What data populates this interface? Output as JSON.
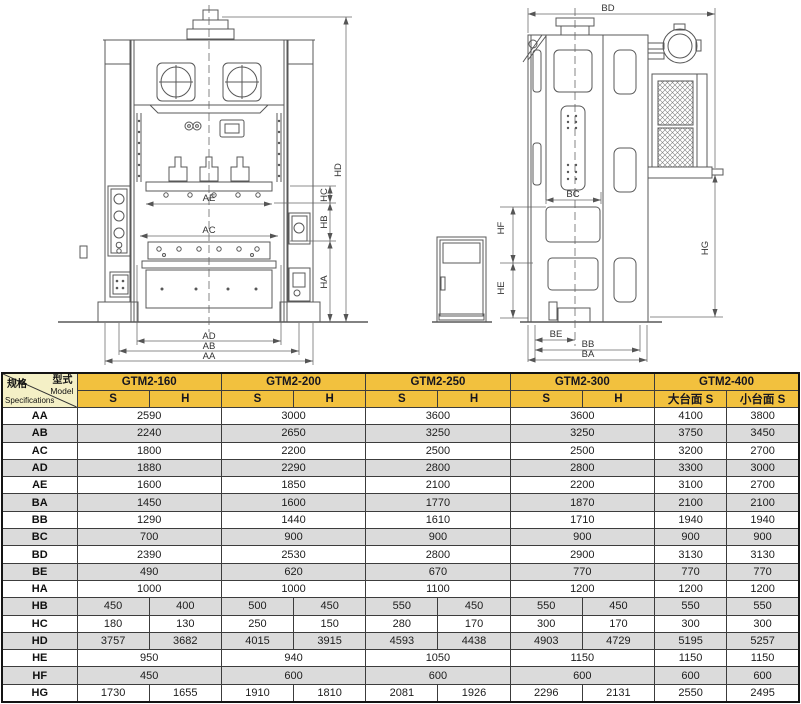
{
  "colors": {
    "header_gold": "#F2C13E",
    "corner_yellow": "#F4F0C6",
    "row_alt_gray": "#DBDBDB",
    "drawing_line": "#585858"
  },
  "drawings": {
    "front_labels": {
      "AA": "AA",
      "AB": "AB",
      "AC": "AC",
      "AD": "AD",
      "AE": "AE",
      "HA": "HA",
      "HB": "HB",
      "HC": "HC",
      "HD": "HD"
    },
    "side_labels": {
      "BA": "BA",
      "BB": "BB",
      "BC": "BC",
      "BD": "BD",
      "BE": "BE",
      "HE": "HE",
      "HF": "HF",
      "HG": "HG"
    }
  },
  "table": {
    "corner": {
      "model_zh": "型式",
      "model_en": "Model",
      "spec_zh": "规格",
      "spec_en": "Specifications"
    },
    "model_groups": [
      {
        "label": "GTM2-160",
        "sub": [
          "S",
          "H"
        ]
      },
      {
        "label": "GTM2-200",
        "sub": [
          "S",
          "H"
        ]
      },
      {
        "label": "GTM2-250",
        "sub": [
          "S",
          "H"
        ]
      },
      {
        "label": "GTM2-300",
        "sub": [
          "S",
          "H"
        ]
      },
      {
        "label": "GTM2-400",
        "sub": [
          "大台面 S",
          "小台面 S"
        ]
      }
    ],
    "rows": [
      {
        "label": "AA",
        "cells": [
          {
            "v": "2590",
            "span": 2
          },
          {
            "v": "3000",
            "span": 2
          },
          {
            "v": "3600",
            "span": 2
          },
          {
            "v": "3600",
            "span": 2
          },
          {
            "v": "4100",
            "span": 1
          },
          {
            "v": "3800",
            "span": 1
          }
        ]
      },
      {
        "label": "AB",
        "cells": [
          {
            "v": "2240",
            "span": 2
          },
          {
            "v": "2650",
            "span": 2
          },
          {
            "v": "3250",
            "span": 2
          },
          {
            "v": "3250",
            "span": 2
          },
          {
            "v": "3750",
            "span": 1
          },
          {
            "v": "3450",
            "span": 1
          }
        ]
      },
      {
        "label": "AC",
        "cells": [
          {
            "v": "1800",
            "span": 2
          },
          {
            "v": "2200",
            "span": 2
          },
          {
            "v": "2500",
            "span": 2
          },
          {
            "v": "2500",
            "span": 2
          },
          {
            "v": "3200",
            "span": 1
          },
          {
            "v": "2700",
            "span": 1
          }
        ]
      },
      {
        "label": "AD",
        "cells": [
          {
            "v": "1880",
            "span": 2
          },
          {
            "v": "2290",
            "span": 2
          },
          {
            "v": "2800",
            "span": 2
          },
          {
            "v": "2800",
            "span": 2
          },
          {
            "v": "3300",
            "span": 1
          },
          {
            "v": "3000",
            "span": 1
          }
        ]
      },
      {
        "label": "AE",
        "cells": [
          {
            "v": "1600",
            "span": 2
          },
          {
            "v": "1850",
            "span": 2
          },
          {
            "v": "2100",
            "span": 2
          },
          {
            "v": "2200",
            "span": 2
          },
          {
            "v": "3100",
            "span": 1
          },
          {
            "v": "2700",
            "span": 1
          }
        ]
      },
      {
        "label": "BA",
        "cells": [
          {
            "v": "1450",
            "span": 2
          },
          {
            "v": "1600",
            "span": 2
          },
          {
            "v": "1770",
            "span": 2
          },
          {
            "v": "1870",
            "span": 2
          },
          {
            "v": "2100",
            "span": 1
          },
          {
            "v": "2100",
            "span": 1
          }
        ]
      },
      {
        "label": "BB",
        "cells": [
          {
            "v": "1290",
            "span": 2
          },
          {
            "v": "1440",
            "span": 2
          },
          {
            "v": "1610",
            "span": 2
          },
          {
            "v": "1710",
            "span": 2
          },
          {
            "v": "1940",
            "span": 1
          },
          {
            "v": "1940",
            "span": 1
          }
        ]
      },
      {
        "label": "BC",
        "cells": [
          {
            "v": "700",
            "span": 2
          },
          {
            "v": "900",
            "span": 2
          },
          {
            "v": "900",
            "span": 2
          },
          {
            "v": "900",
            "span": 2
          },
          {
            "v": "900",
            "span": 1
          },
          {
            "v": "900",
            "span": 1
          }
        ]
      },
      {
        "label": "BD",
        "cells": [
          {
            "v": "2390",
            "span": 2
          },
          {
            "v": "2530",
            "span": 2
          },
          {
            "v": "2800",
            "span": 2
          },
          {
            "v": "2900",
            "span": 2
          },
          {
            "v": "3130",
            "span": 1
          },
          {
            "v": "3130",
            "span": 1
          }
        ]
      },
      {
        "label": "BE",
        "cells": [
          {
            "v": "490",
            "span": 2
          },
          {
            "v": "620",
            "span": 2
          },
          {
            "v": "670",
            "span": 2
          },
          {
            "v": "770",
            "span": 2
          },
          {
            "v": "770",
            "span": 1
          },
          {
            "v": "770",
            "span": 1
          }
        ]
      },
      {
        "label": "HA",
        "cells": [
          {
            "v": "1000",
            "span": 2
          },
          {
            "v": "1000",
            "span": 2
          },
          {
            "v": "1100",
            "span": 2
          },
          {
            "v": "1200",
            "span": 2
          },
          {
            "v": "1200",
            "span": 1
          },
          {
            "v": "1200",
            "span": 1
          }
        ]
      },
      {
        "label": "HB",
        "cells": [
          {
            "v": "450",
            "span": 1
          },
          {
            "v": "400",
            "span": 1
          },
          {
            "v": "500",
            "span": 1
          },
          {
            "v": "450",
            "span": 1
          },
          {
            "v": "550",
            "span": 1
          },
          {
            "v": "450",
            "span": 1
          },
          {
            "v": "550",
            "span": 1
          },
          {
            "v": "450",
            "span": 1
          },
          {
            "v": "550",
            "span": 1
          },
          {
            "v": "550",
            "span": 1
          }
        ]
      },
      {
        "label": "HC",
        "cells": [
          {
            "v": "180",
            "span": 1
          },
          {
            "v": "130",
            "span": 1
          },
          {
            "v": "250",
            "span": 1
          },
          {
            "v": "150",
            "span": 1
          },
          {
            "v": "280",
            "span": 1
          },
          {
            "v": "170",
            "span": 1
          },
          {
            "v": "300",
            "span": 1
          },
          {
            "v": "170",
            "span": 1
          },
          {
            "v": "300",
            "span": 1
          },
          {
            "v": "300",
            "span": 1
          }
        ]
      },
      {
        "label": "HD",
        "cells": [
          {
            "v": "3757",
            "span": 1
          },
          {
            "v": "3682",
            "span": 1
          },
          {
            "v": "4015",
            "span": 1
          },
          {
            "v": "3915",
            "span": 1
          },
          {
            "v": "4593",
            "span": 1
          },
          {
            "v": "4438",
            "span": 1
          },
          {
            "v": "4903",
            "span": 1
          },
          {
            "v": "4729",
            "span": 1
          },
          {
            "v": "5195",
            "span": 1
          },
          {
            "v": "5257",
            "span": 1
          }
        ]
      },
      {
        "label": "HE",
        "cells": [
          {
            "v": "950",
            "span": 2
          },
          {
            "v": "940",
            "span": 2
          },
          {
            "v": "1050",
            "span": 2
          },
          {
            "v": "1150",
            "span": 2
          },
          {
            "v": "1150",
            "span": 1
          },
          {
            "v": "1150",
            "span": 1
          }
        ]
      },
      {
        "label": "HF",
        "cells": [
          {
            "v": "450",
            "span": 2
          },
          {
            "v": "600",
            "span": 2
          },
          {
            "v": "600",
            "span": 2
          },
          {
            "v": "600",
            "span": 2
          },
          {
            "v": "600",
            "span": 1
          },
          {
            "v": "600",
            "span": 1
          }
        ]
      },
      {
        "label": "HG",
        "cells": [
          {
            "v": "1730",
            "span": 1
          },
          {
            "v": "1655",
            "span": 1
          },
          {
            "v": "1910",
            "span": 1
          },
          {
            "v": "1810",
            "span": 1
          },
          {
            "v": "2081",
            "span": 1
          },
          {
            "v": "1926",
            "span": 1
          },
          {
            "v": "2296",
            "span": 1
          },
          {
            "v": "2131",
            "span": 1
          },
          {
            "v": "2550",
            "span": 1
          },
          {
            "v": "2495",
            "span": 1
          }
        ]
      }
    ]
  }
}
